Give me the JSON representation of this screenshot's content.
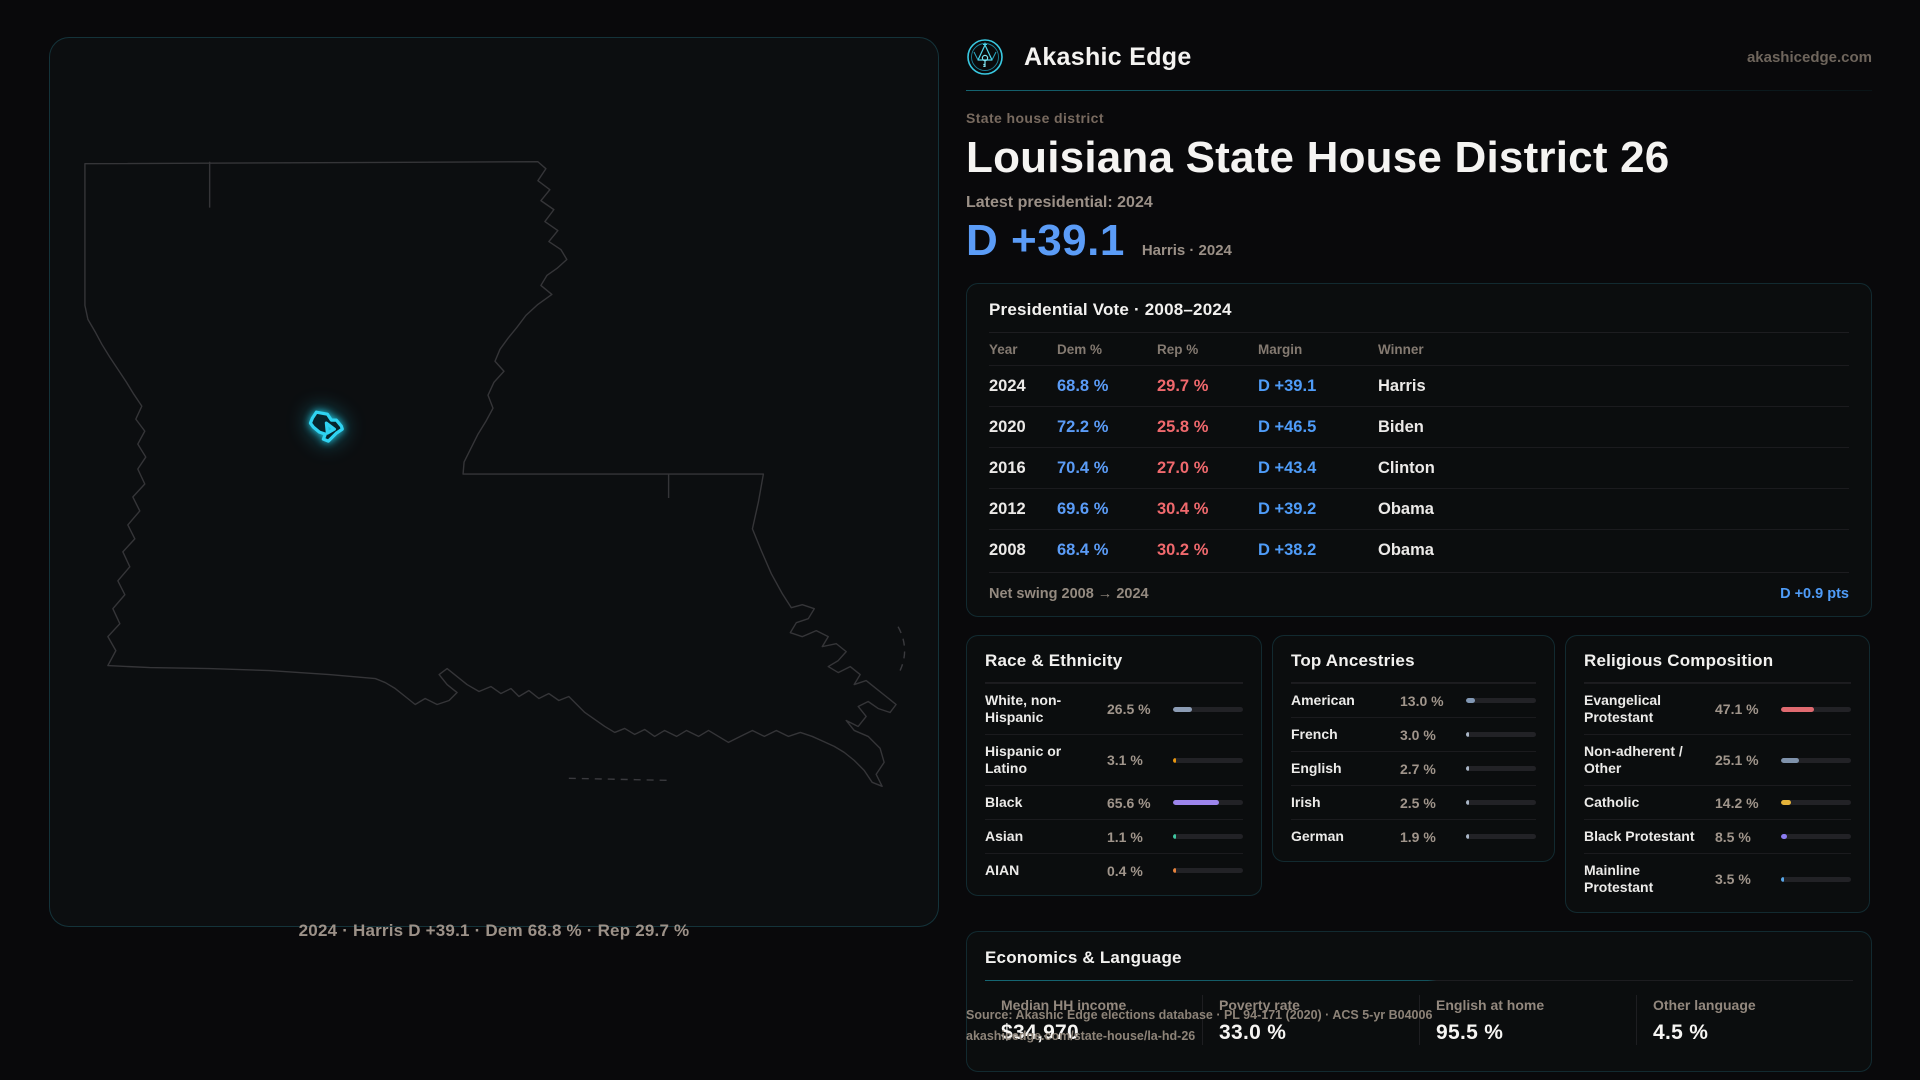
{
  "brand": {
    "name": "Akashic Edge",
    "domain": "akashicedge.com",
    "logo_icon": "akashic-emblem-icon"
  },
  "header": {
    "eyebrow": "State house district",
    "title": "Louisiana State House District 26",
    "latest_label": "Latest presidential: 2024",
    "headline_margin": "D +39.1",
    "headline_context": "Harris · 2024"
  },
  "map": {
    "caption": "2024 · Harris D +39.1 · Dem 68.8 % · Rep 29.7 %",
    "highlight_name": "district-26-shape"
  },
  "colors": {
    "accent_teal": "#2fd3f2",
    "dem_blue": "#5b9cf7",
    "rep_red": "#f0696d"
  },
  "presidential": {
    "title": "Presidential Vote · 2008–2024",
    "columns": [
      "Year",
      "Dem %",
      "Rep %",
      "Margin",
      "Winner"
    ],
    "rows": [
      {
        "year": "2024",
        "dem": "68.8 %",
        "rep": "29.7 %",
        "margin": "D +39.1",
        "winner": "Harris"
      },
      {
        "year": "2020",
        "dem": "72.2 %",
        "rep": "25.8 %",
        "margin": "D +46.5",
        "winner": "Biden"
      },
      {
        "year": "2016",
        "dem": "70.4 %",
        "rep": "27.0 %",
        "margin": "D +43.4",
        "winner": "Clinton"
      },
      {
        "year": "2012",
        "dem": "69.6 %",
        "rep": "30.4 %",
        "margin": "D +39.2",
        "winner": "Obama"
      },
      {
        "year": "2008",
        "dem": "68.4 %",
        "rep": "30.2 %",
        "margin": "D +38.2",
        "winner": "Obama"
      }
    ],
    "net_swing_label": "Net swing 2008 → 2024",
    "net_swing_value": "D +0.9 pts"
  },
  "race": {
    "title": "Race & Ethnicity",
    "rows": [
      {
        "label": "White, non-Hispanic",
        "value": "26.5 %",
        "pct": 26.5,
        "color": "#8c9cb4"
      },
      {
        "label": "Hispanic or Latino",
        "value": "3.1 %",
        "pct": 3.1,
        "color": "#e8960f"
      },
      {
        "label": "Black",
        "value": "65.6 %",
        "pct": 65.6,
        "color": "#9d85ec"
      },
      {
        "label": "Asian",
        "value": "1.1 %",
        "pct": 1.1,
        "color": "#3fc6a0"
      },
      {
        "label": "AIAN",
        "value": "0.4 %",
        "pct": 0.4,
        "color": "#e8833c"
      }
    ]
  },
  "ancestries": {
    "title": "Top Ancestries",
    "rows": [
      {
        "label": "American",
        "value": "13.0 %",
        "pct": 13.0,
        "color": "#8298b4"
      },
      {
        "label": "French",
        "value": "3.0 %",
        "pct": 3.0,
        "color": "#aab6c6"
      },
      {
        "label": "English",
        "value": "2.7 %",
        "pct": 2.7,
        "color": "#aab6c6"
      },
      {
        "label": "Irish",
        "value": "2.5 %",
        "pct": 2.5,
        "color": "#aab6c6"
      },
      {
        "label": "German",
        "value": "1.9 %",
        "pct": 1.9,
        "color": "#aab6c6"
      }
    ]
  },
  "religion": {
    "title": "Religious Composition",
    "rows": [
      {
        "label": "Evangelical Protestant",
        "value": "47.1 %",
        "pct": 47.1,
        "color": "#e06a70"
      },
      {
        "label": "Non-adherent / Other",
        "value": "25.1 %",
        "pct": 25.1,
        "color": "#7f92ab"
      },
      {
        "label": "Catholic",
        "value": "14.2 %",
        "pct": 14.2,
        "color": "#e5b33a"
      },
      {
        "label": "Black Protestant",
        "value": "8.5 %",
        "pct": 8.5,
        "color": "#8b7bf0"
      },
      {
        "label": "Mainline Protestant",
        "value": "3.5 %",
        "pct": 3.5,
        "color": "#58a6e8"
      }
    ]
  },
  "economics": {
    "title": "Economics & Language",
    "stats": [
      {
        "label": "Median HH income",
        "value": "$34,970"
      },
      {
        "label": "Poverty rate",
        "value": "33.0 %"
      },
      {
        "label": "English at home",
        "value": "95.5 %"
      },
      {
        "label": "Other language",
        "value": "4.5 %"
      }
    ]
  },
  "source": {
    "line1": "Source: Akashic Edge elections database · PL 94-171 (2020) · ACS 5-yr B04006",
    "line2": "akashicedge.com/state-house/la-hd-26"
  }
}
